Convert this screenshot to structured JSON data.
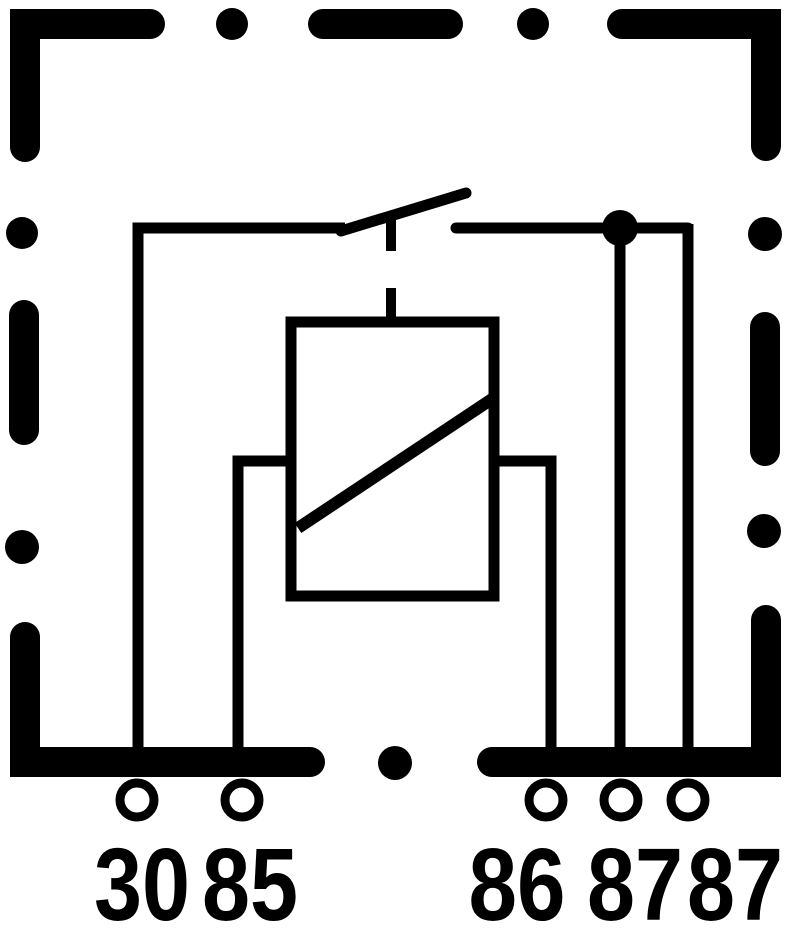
{
  "diagram": {
    "kind": "relay-wiring-schematic",
    "border_style": "thick-dashed",
    "colors": {
      "ink": "#000000",
      "paper": "#ffffff"
    },
    "components": [
      "relay-housing-dashed-border",
      "switch-blade",
      "actuator-link-dashed",
      "coil-box",
      "coil-winding-diagonal",
      "junction-dot",
      "terminal-pin-circles"
    ],
    "terminals": [
      {
        "label": "30"
      },
      {
        "label": "85"
      },
      {
        "label": "86"
      },
      {
        "label": "87"
      },
      {
        "label": "87"
      }
    ]
  }
}
